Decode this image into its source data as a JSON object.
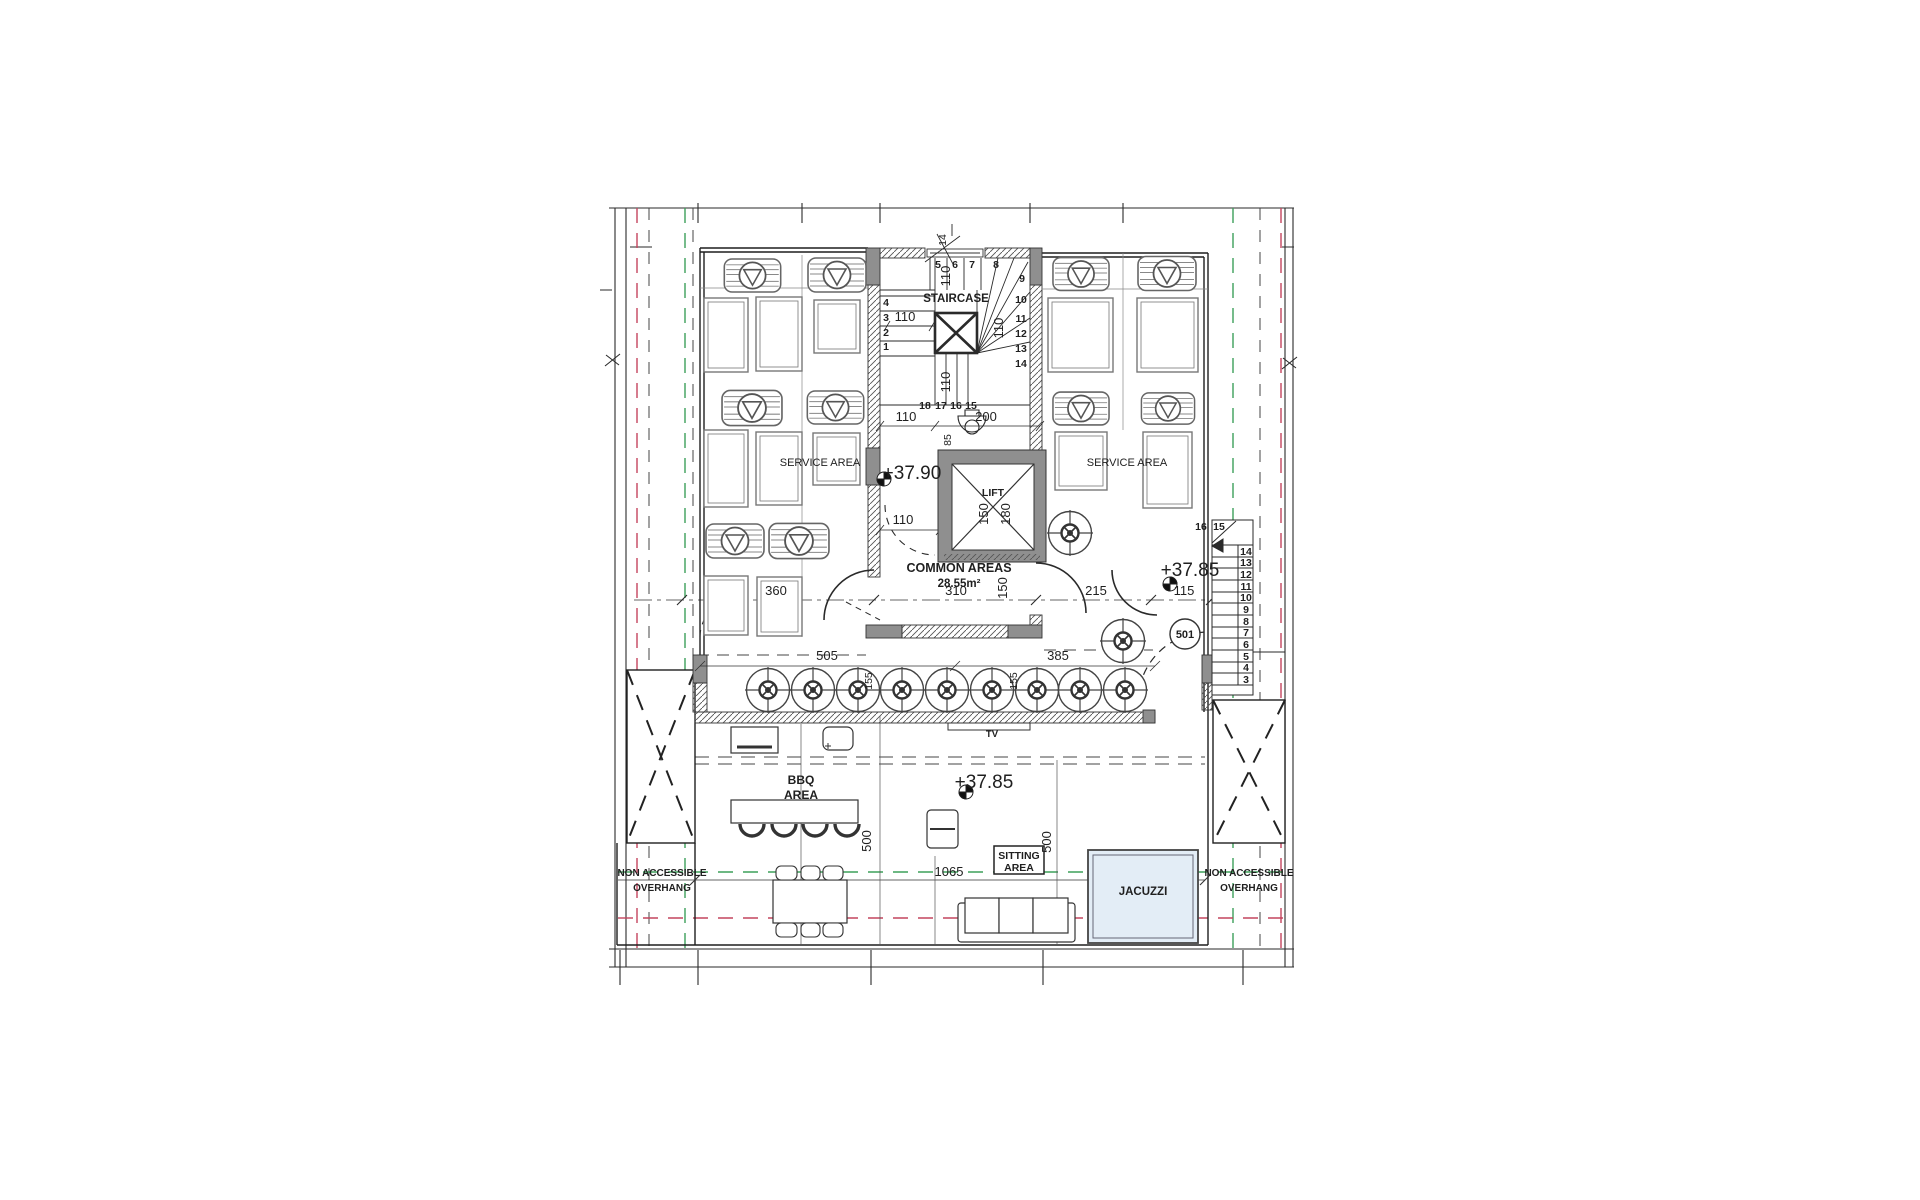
{
  "plan": {
    "rooms": {
      "staircase": "STAIRCASE",
      "lift": "LIFT",
      "common_areas": "COMMON AREAS",
      "common_areas_area": "28.55m²",
      "service_area_left": "SERVICE AREA",
      "service_area_right": "SERVICE AREA",
      "bbq_line1": "BBQ",
      "bbq_line2": "AREA",
      "sitting_line1": "SITTING",
      "sitting_line2": "AREA",
      "jacuzzi": "JACUZZI",
      "tv": "TV",
      "overhang_line1": "NON ACCESSIBLE",
      "overhang_line2": "OVERHANG"
    },
    "unit_number": "501",
    "levels": {
      "upper": "+37.90",
      "terrace": "+37.85"
    },
    "dims": {
      "d14": "14",
      "d85": "85",
      "d110": "110",
      "d115": "115",
      "d150": "150",
      "d155": "155",
      "d180": "180",
      "d200": "200",
      "d215": "215",
      "d310": "310",
      "d360": "360",
      "d385": "385",
      "d500": "500",
      "d505": "505",
      "d1065": "1065"
    },
    "stair_top_steps": [
      "1",
      "2",
      "3",
      "4",
      "5",
      "6",
      "7",
      "8",
      "9",
      "10",
      "11",
      "12",
      "13",
      "14",
      "15",
      "16",
      "17",
      "18"
    ],
    "stair_right_steps": [
      "3",
      "4",
      "5",
      "6",
      "7",
      "8",
      "9",
      "10",
      "11",
      "12",
      "13",
      "14",
      "15",
      "16"
    ],
    "colors": {
      "line": "#1f1f1f",
      "wall_gray": "#8f8f8f",
      "hatch": "#555555",
      "green_dash": "#3da05a",
      "red_dash": "#c4455e",
      "black_dash": "#444444",
      "jacuzzi_fill": "#e3edf6"
    }
  }
}
